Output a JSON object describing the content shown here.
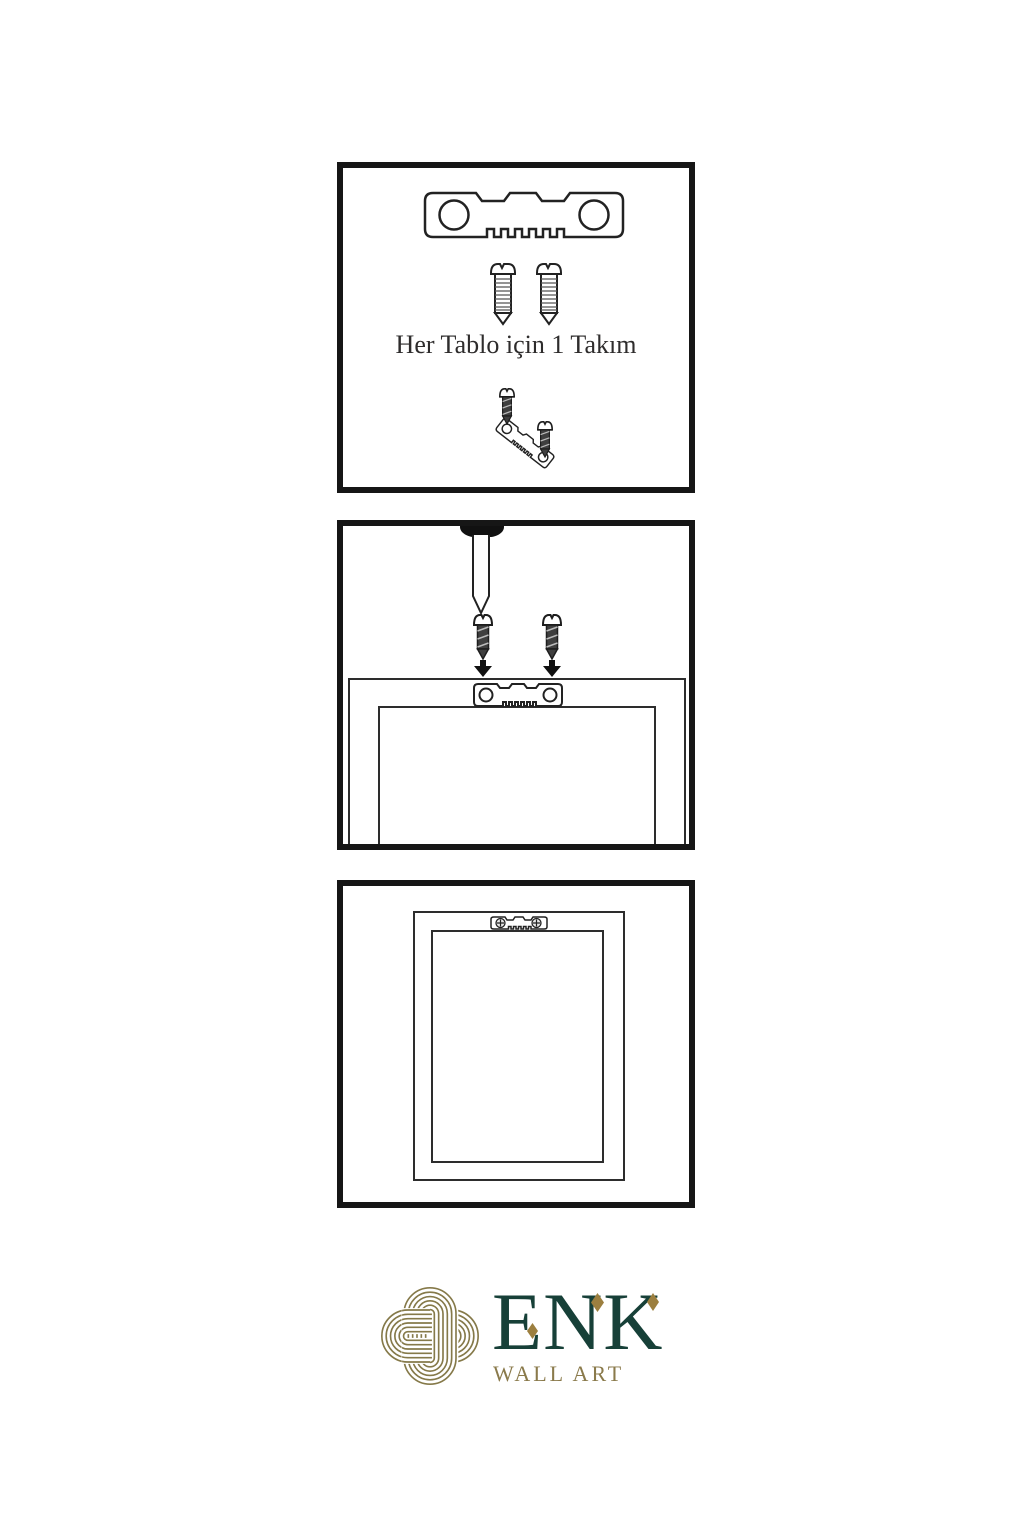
{
  "page": {
    "background_color": "#ffffff",
    "panel_border_color": "#161616",
    "line_art_color": "#222222"
  },
  "panels": {
    "kit": {
      "label": "Her Tablo için 1 Takım",
      "icons": [
        "sawtooth-hanger-icon",
        "screw-icon",
        "screw-icon",
        "angled-hanger-with-screws-icon"
      ]
    },
    "install": {
      "icons": [
        "screwdriver-icon",
        "dark-screw-icon",
        "dark-screw-icon",
        "arrow-down-icon",
        "arrow-down-icon",
        "frame-back-icon",
        "sawtooth-hanger-icon"
      ]
    },
    "result": {
      "icons": [
        "frame-back-icon",
        "mounted-sawtooth-hanger-icon"
      ]
    }
  },
  "brand": {
    "logo_icon": "knot-logo-icon",
    "name": "ENK",
    "tagline": "WALL ART",
    "colors": {
      "green": "#174038",
      "gold": "#8a7a4b",
      "diamond_gold": "#9c7f3f",
      "knot_gold": "#857949"
    }
  }
}
